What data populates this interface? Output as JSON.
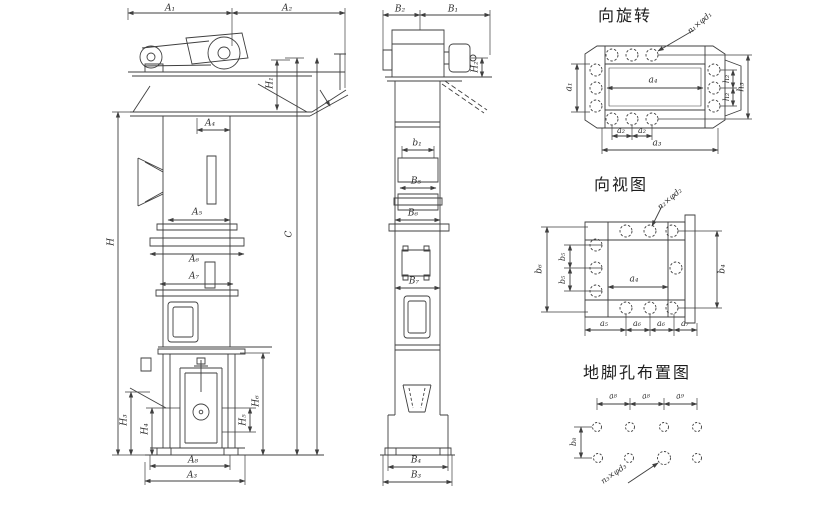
{
  "drawing": {
    "type": "bucket-elevator-outline-drawing",
    "line_color": "#3f3f3f",
    "background": "#ffffff"
  },
  "front_view": {
    "dims": {
      "a1": "A₁",
      "a2": "A₂",
      "h1": "H₁",
      "a4": "A₄",
      "a5": "A₅",
      "a6": "A₆",
      "a7": "A₇",
      "h": "H",
      "c": "C",
      "h3": "H₃",
      "h4": "H₄",
      "h5": "H₅",
      "h6": "H₆",
      "a8": "A₈",
      "a3": "A₃"
    }
  },
  "side_view": {
    "dims": {
      "b2": "B₂",
      "b1": "B₁",
      "h2": "H₂",
      "b1s": "b₁",
      "b5": "B₅",
      "b6": "B₆",
      "b7": "B₇",
      "b4": "B₄",
      "b3": "B₃"
    }
  },
  "rotation_view": {
    "title": "向旋转",
    "leader": "n₁×φd₁",
    "dims": {
      "a1": "a₁",
      "a4": "a₄",
      "a2a": "a₂",
      "a2b": "a₂",
      "a3": "a₃",
      "h2a": "h₂",
      "h2b": "h₂",
      "h3": "h₃"
    }
  },
  "direction_view": {
    "title": "向视图",
    "leader": "n₂×φd₂",
    "dims": {
      "b6": "b₆",
      "b5a": "b₅",
      "b5b": "b₅",
      "a4": "a₄",
      "b4": "b₄",
      "a5": "a₅",
      "a6a": "a₆",
      "a6b": "a₆",
      "a7": "a₇"
    }
  },
  "anchor_view": {
    "title": "地脚孔布置图",
    "leader": "n₃×φd₃",
    "dims": {
      "a8a": "a₈",
      "a8b": "a₈",
      "a9": "a₉",
      "b8": "b₈"
    }
  }
}
